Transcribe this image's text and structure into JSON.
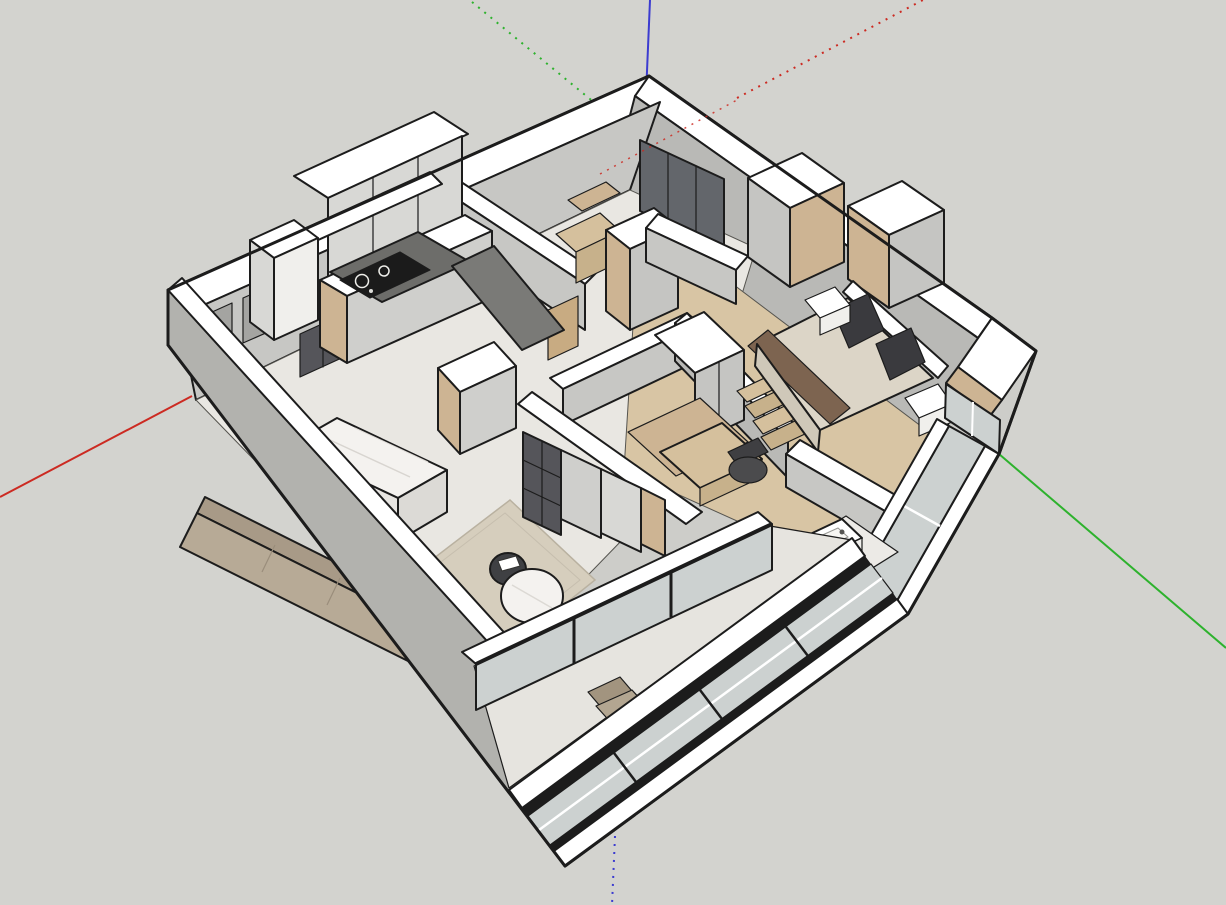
{
  "viewport": {
    "app": "3d-modeling-viewport",
    "content": "apartment-3d-floor-plan-model",
    "width": 1226,
    "height": 905
  },
  "axes": {
    "red_axis": {
      "color": "#cc2a22",
      "solid_segment": "lower-left",
      "dotted_segment": "upper-right"
    },
    "green_axis": {
      "color": "#2db22d",
      "solid_segment": "lower-right",
      "dotted_segment": "upper-left"
    },
    "blue_axis": {
      "color": "#3b3bd0",
      "solid_segment": "top",
      "dotted_segment": "bottom"
    }
  },
  "scene": {
    "rooms": [
      "kitchen",
      "living-dining",
      "hallway",
      "study-nook",
      "walk-in-closet",
      "master-bedroom",
      "tatami-bedroom",
      "bathroom",
      "balcony"
    ],
    "furniture": [
      "kitchen-cabinets",
      "gas-cooktop",
      "marble-island",
      "sofa",
      "round-coffee-table",
      "round-dining-table",
      "storage-wall",
      "wardrobes",
      "double-bed",
      "nightstands",
      "wood-steps",
      "desk-chair",
      "platform-bed",
      "bathroom-sink",
      "balcony-chairs"
    ]
  },
  "palette": {
    "bg": "#d3d3cf",
    "line": "#1c1c1c",
    "baseFill": "#cdcdc9",
    "white": "#ffffff",
    "offWhite": "#f0efec",
    "extWall": "#b2b2ae",
    "intWall": "#c7c7c4",
    "intWallDim": "#b9b9b6",
    "intWallDark": "#a4a4a1",
    "floorMarble": "#e9e7e2",
    "floorWood": "#d8c5a4",
    "floorBalcony": "#e6e4df",
    "floorBath": "#eceae6",
    "rug": "#d6cebd",
    "sofaBack": "#a89a87",
    "sofaSeat": "#b7aa96",
    "woodLight": "#d5c09d",
    "woodMid": "#c7b18b",
    "woodSide": "#cdb493",
    "doorWood": "#c8ab82",
    "counterDark": "#6d6d6a",
    "counterMid": "#7a7a77",
    "cooktop": "#1b1b1b",
    "cabinetLight": "#d8d8d5",
    "cabinetGray": "#cfcfcc",
    "cabinetDim": "#c5c5c2",
    "darkGrid": "#55555a",
    "darkCab": "#3f3f42",
    "glassDark": "#63666b",
    "glassLight": "#ccd1d0",
    "frameDark": "#1c1c1c",
    "marbleTop": "#f4f2ef",
    "marbleSide": "#e7e5e1",
    "marbleEnd": "#dcdad6",
    "bedCover": "#dcd5c7",
    "bedSide": "#cfc8b9",
    "runner": "#7d6450",
    "pillow": "#3a3a3e",
    "chairDark": "#4b4b4d",
    "chairBeige": "#b3a691",
    "chairBeigeBack": "#a2947f",
    "stool": "#4e4e4c",
    "tableDark": "#3f4043",
    "diningBase": "#d8d6d2",
    "axisRed": "#cc2a22",
    "axisGreen": "#2db22d",
    "axisBlue": "#3b3bd0"
  }
}
